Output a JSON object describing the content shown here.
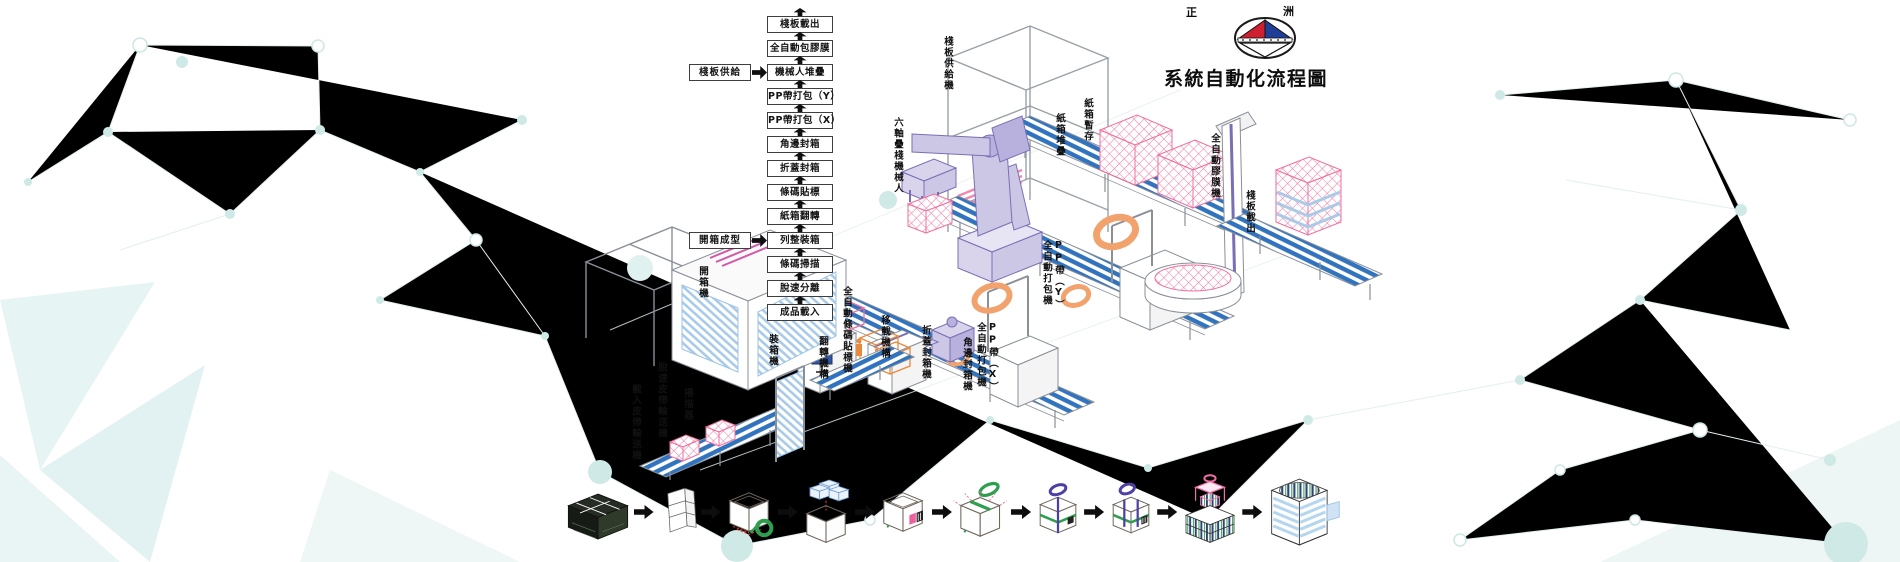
{
  "header": {
    "title": "系統自動化流程圖",
    "logo": {
      "left_text": "正",
      "right_text": "洲"
    }
  },
  "flowchart": {
    "steps": [
      "棧板載出",
      "全自動包膠膜",
      "機械人堆疊",
      "PP帶打包（Y）",
      "PP帶打包（X）",
      "角邊封箱",
      "折蓋封箱",
      "條碼貼標",
      "紙箱翻轉",
      "列整裝箱",
      "條碼掃描",
      "脫速分離",
      "成品載入"
    ],
    "inputs": [
      {
        "label": "棧板供給",
        "target": "機械人堆疊"
      },
      {
        "label": "開箱成型",
        "target": "列整裝箱"
      }
    ]
  },
  "machines": [
    {
      "label": "棧板供給機"
    },
    {
      "label": "六軸疊棧機械人"
    },
    {
      "label": "紙箱堆疊"
    },
    {
      "label": "紙箱暫存"
    },
    {
      "label": "全自動膠膜機"
    },
    {
      "label": "棧板載出"
    },
    {
      "label": "PP帶（Y）\n全自動打包機"
    },
    {
      "label": "PP帶（X）\n全自動打包機"
    },
    {
      "label": "角邊封箱機"
    },
    {
      "label": "折蓋封箱機"
    },
    {
      "label": "移載機構"
    },
    {
      "label": "全自動條碼貼標機"
    },
    {
      "label": "翻轉機構"
    },
    {
      "label": "裝箱機"
    },
    {
      "label": "開箱機"
    },
    {
      "label": "掃描器"
    },
    {
      "label": "脫速皮帶輸送機"
    },
    {
      "label": "載入皮帶輸送機"
    }
  ],
  "process_stages": [
    {
      "name": "carton-stack"
    },
    {
      "name": "carton-blank"
    },
    {
      "name": "box-forming-bottom-taping"
    },
    {
      "name": "product-loading"
    },
    {
      "name": "barcode-labeling"
    },
    {
      "name": "flap-folding-top-taping"
    },
    {
      "name": "pp-strapping-x"
    },
    {
      "name": "pp-strapping-y"
    },
    {
      "name": "robot-palletizing"
    },
    {
      "name": "film-wrapped-pallet"
    }
  ],
  "colors": {
    "conveyor_blue": "#3273bd",
    "carton_pink": "#f27ba3",
    "robot_purple": "#8b7fc3",
    "strap_coil_orange": "#f2a36d",
    "tape_green": "#2f9e4f",
    "strap_blue": "#4d3fa3",
    "glass_blue": "#a9cbe8",
    "logo_red": "#cf2030",
    "logo_blue": "#1f3e98",
    "background_teal": "#d9eeee"
  }
}
